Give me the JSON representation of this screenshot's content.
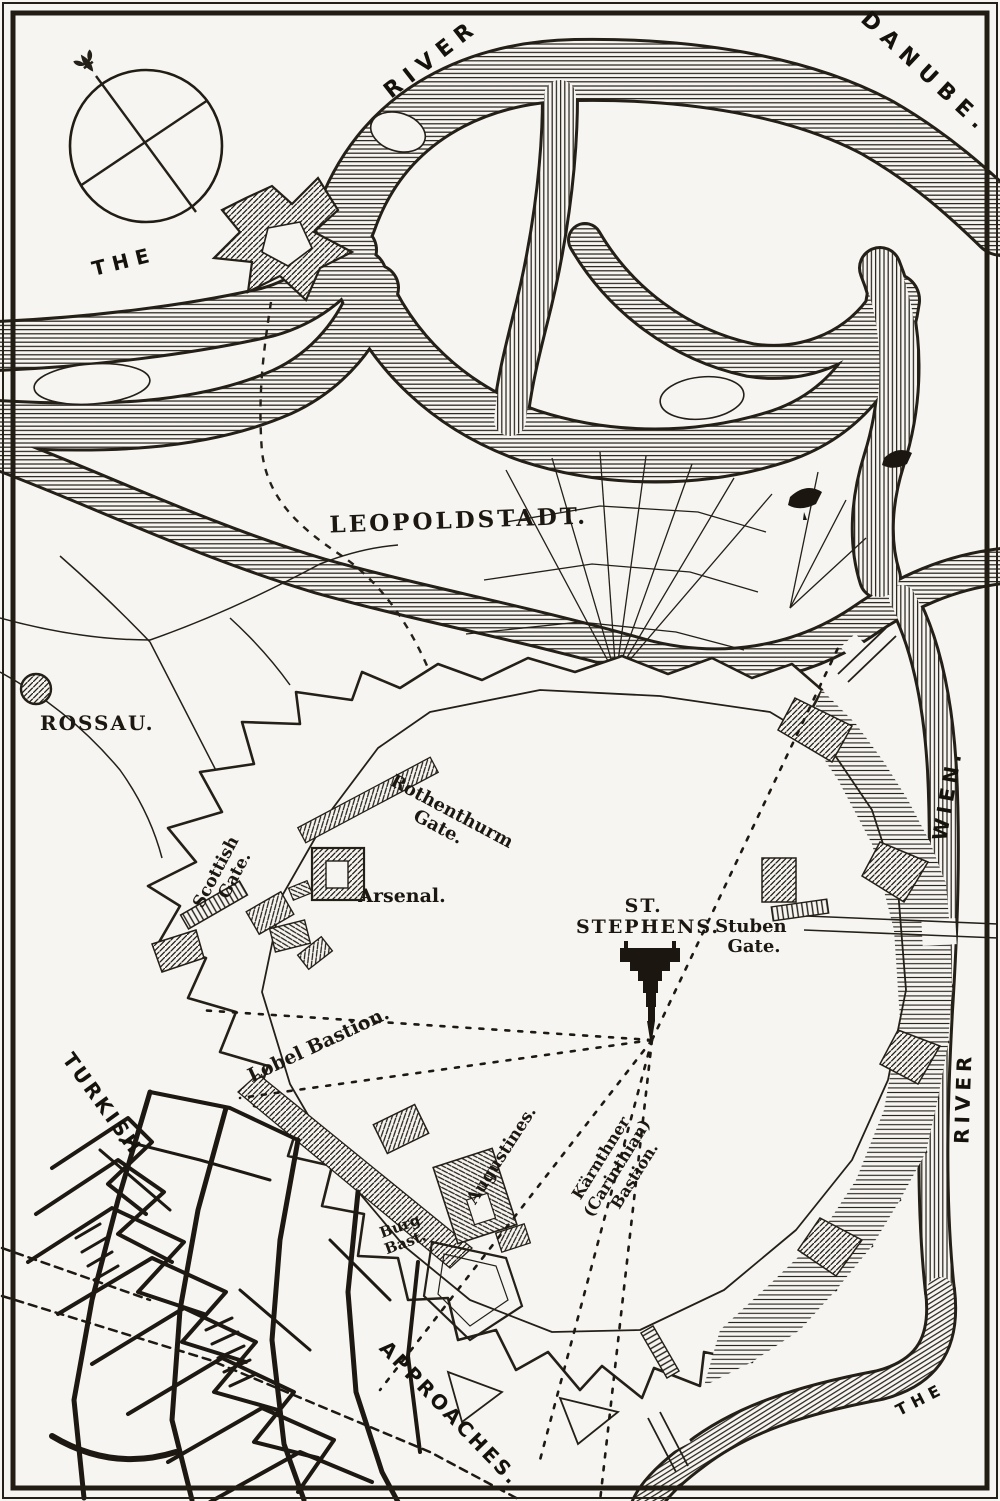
{
  "labels": {
    "the_upper": "THE",
    "river_upper": "RIVER",
    "danube": "DANUBE.",
    "leopoldstadt": "LEOPOLDSTADT.",
    "rossau": "ROSSAU.",
    "scottish_gate": {
      "lines": [
        "Scottish",
        "Gate."
      ]
    },
    "rothenthurm_gate": {
      "lines": [
        "Rothenthurm",
        "Gate."
      ]
    },
    "arsenal": "Arsenal.",
    "st_stephens": {
      "lines": [
        "ST.",
        "STEPHENS."
      ]
    },
    "stuben_gate": {
      "lines": [
        "Stuben",
        "Gate."
      ]
    },
    "lobel_bastion": "Lobel Bastion.",
    "augustines": "Augustines.",
    "karnthner_bastion": {
      "lines": [
        "Kärnthner",
        "(Carinthian)",
        "Bastion."
      ]
    },
    "burg_bastion": {
      "lines": [
        "Burg",
        "Bast."
      ]
    },
    "turkish": "TURKISH",
    "approaches": "APPROACHES.",
    "wien": "WIEN.",
    "river_right": "RIVER",
    "the_lower": "THE"
  },
  "icons": {
    "compass": "compass-rose-icon",
    "fleur": "fleur-de-lis-icon",
    "boat": "boat-icon",
    "cathedral": "st-stephens-cathedral-icon",
    "marker": "rossau-dot-icon"
  },
  "colors": {
    "ink": "#211c14",
    "paper": "#f6f5f1"
  }
}
